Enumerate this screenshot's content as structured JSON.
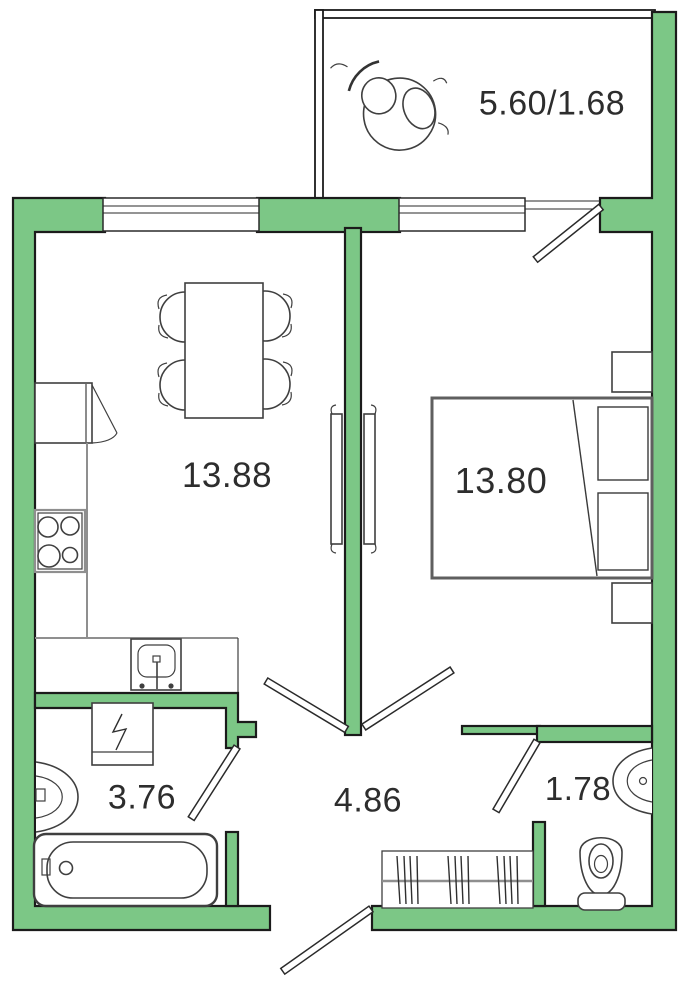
{
  "colors": {
    "wall_fill": "#7cc786",
    "wall_outline": "#1b1b1b",
    "furniture_stroke": "#3f3f3f",
    "counter_stroke": "#8f8f8f",
    "bed_stroke": "#5f5f5f",
    "label_color": "#2d2d2d"
  },
  "rooms": {
    "balcony": {
      "area_label": "5.60/1.68"
    },
    "kitchen_living": {
      "area_label": "13.88"
    },
    "bedroom": {
      "area_label": "13.80"
    },
    "bathroom": {
      "area_label": "3.76"
    },
    "hallway": {
      "area_label": "4.86"
    },
    "toilet": {
      "area_label": "1.78"
    }
  },
  "furniture": {
    "balcony": [
      "armchairs"
    ],
    "kitchen_living": [
      "refrigerator",
      "counter",
      "stove",
      "kitchen-sink",
      "dining-table",
      "four-chairs"
    ],
    "bedroom": [
      "double-bed",
      "pillows",
      "nightstands",
      "sliding-door-panels"
    ],
    "bathroom": [
      "washing-machine",
      "wash-basin",
      "bathtub"
    ],
    "hallway": [
      "wardrobe-with-hangers"
    ],
    "toilet": [
      "wash-basin",
      "toilet"
    ]
  }
}
